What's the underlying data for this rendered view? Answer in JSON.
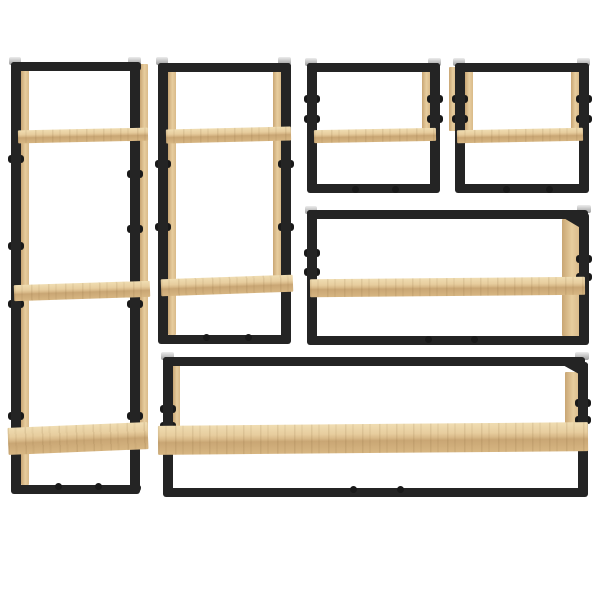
{
  "scene": {
    "type": "product-photo",
    "subject": "6-piece wall-mounted shelf set with black steel frames and light oak (sonoma) boards",
    "background_color": "#ffffff",
    "units": [
      {
        "id": "tall-left",
        "orientation": "vertical",
        "shelf_count": 3,
        "hardware": [
          "wall-brackets",
          "bolt-knobs",
          "screw-dots"
        ]
      },
      {
        "id": "vertical-center-left",
        "orientation": "vertical",
        "shelf_count": 2,
        "hardware": [
          "wall-brackets",
          "bolt-knobs",
          "screw-dots"
        ]
      },
      {
        "id": "small-top-center",
        "orientation": "horizontal",
        "shelf_count": 1,
        "hardware": [
          "wall-brackets",
          "bolt-knobs",
          "screw-dots"
        ]
      },
      {
        "id": "small-top-right",
        "orientation": "horizontal",
        "shelf_count": 1,
        "hardware": [
          "wall-brackets",
          "bolt-knobs",
          "screw-dots"
        ]
      },
      {
        "id": "wide-middle-right",
        "orientation": "horizontal",
        "shelf_count": 1,
        "hardware": [
          "wall-brackets",
          "bolt-knobs",
          "screw-dots"
        ]
      },
      {
        "id": "long-bottom",
        "orientation": "horizontal",
        "shelf_count": 1,
        "hardware": [
          "wall-brackets",
          "bolt-knobs",
          "screw-dots"
        ]
      }
    ]
  },
  "colors": {
    "frame": "#242424",
    "frame_dark": "#191919",
    "wood_hi": "#f0ddb2",
    "wood_top": "#e7cd9e",
    "wood_mid": "#d9ba89",
    "wood_edge": "#c9a674",
    "wood_mid2": "#d7b682",
    "bracket_light": "#ececec",
    "bracket_dark": "#9c9c9c",
    "background": "#ffffff"
  }
}
